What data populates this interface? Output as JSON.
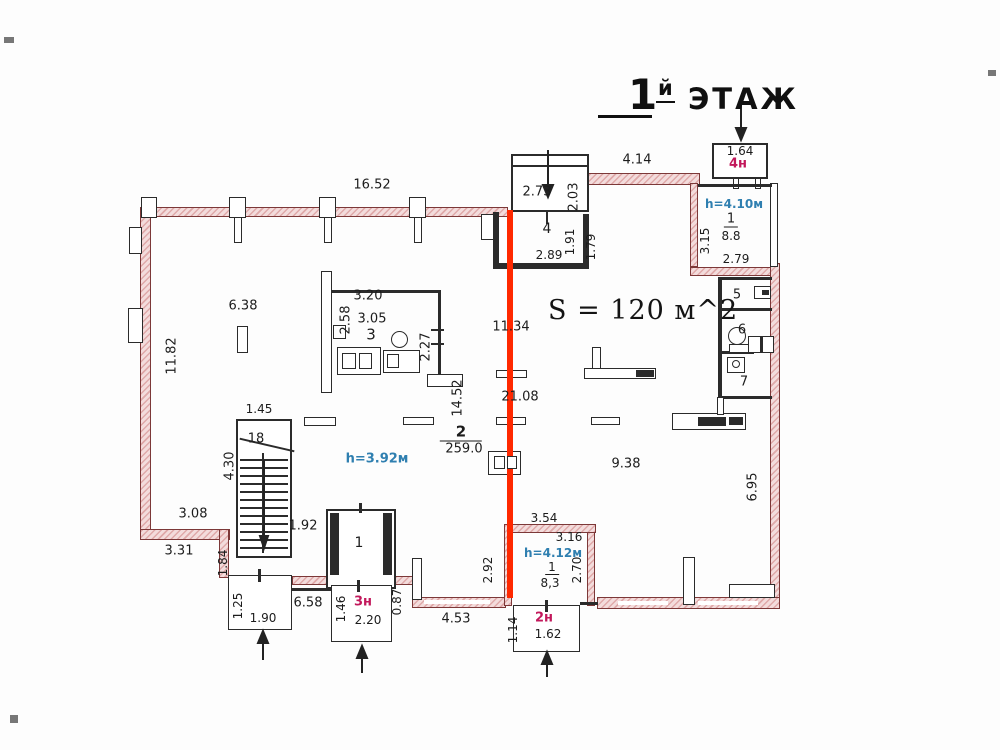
{
  "title": {
    "number": "1",
    "suffix": "й",
    "word": "ЭТАЖ"
  },
  "area_label": "S = 120 м^2",
  "colors": {
    "highlight": "#ff2800",
    "entrance_text": "#c2185b",
    "height_text": "#2f7fb0",
    "wall_accent": "#7c3838"
  },
  "labels": [
    {
      "name": "dim-16-52",
      "text": "16.52",
      "x": 372,
      "y": 185
    },
    {
      "name": "dim-4-14",
      "text": "4.14",
      "x": 637,
      "y": 160
    },
    {
      "name": "dim-2-73",
      "text": "2.73",
      "x": 537,
      "y": 192
    },
    {
      "name": "dim-2-03",
      "text": "2.03",
      "x": 574,
      "y": 197,
      "rot": 1
    },
    {
      "name": "dim-1-64",
      "text": "1.64",
      "x": 740,
      "y": 151,
      "size": 12
    },
    {
      "name": "entrance-4n",
      "text": "4н",
      "x": 738,
      "y": 164,
      "color": "#c2185b",
      "bold": 1
    },
    {
      "name": "height-room1",
      "text": "h=4.10м",
      "x": 734,
      "y": 204,
      "color": "#2f7fb0",
      "size": 12,
      "bold": 1
    },
    {
      "name": "room1-number",
      "text": "1",
      "x": 731,
      "y": 220,
      "size": 13,
      "ul": 1
    },
    {
      "name": "room1-area",
      "text": "8.8",
      "x": 731,
      "y": 236,
      "size": 12
    },
    {
      "name": "dim-3-15",
      "text": "3.15",
      "x": 705,
      "y": 241,
      "rot": 1,
      "size": 12
    },
    {
      "name": "dim-2-79",
      "text": "2.79",
      "x": 736,
      "y": 259,
      "size": 12
    },
    {
      "name": "room4-number",
      "text": "4",
      "x": 547,
      "y": 229,
      "size": 14
    },
    {
      "name": "dim-2-89",
      "text": "2.89",
      "x": 549,
      "y": 255,
      "size": 12
    },
    {
      "name": "dim-1-91",
      "text": "1.91",
      "x": 570,
      "y": 242,
      "rot": 1,
      "size": 12
    },
    {
      "name": "dim-1-79",
      "text": "1.79",
      "x": 591,
      "y": 247,
      "rot": 1,
      "size": 12
    },
    {
      "name": "dim-6-38",
      "text": "6.38",
      "x": 243,
      "y": 306
    },
    {
      "name": "dim-3-20",
      "text": "3.20",
      "x": 368,
      "y": 296
    },
    {
      "name": "dim-2-58",
      "text": "2.58",
      "x": 346,
      "y": 320,
      "rot": 1
    },
    {
      "name": "dim-3-05",
      "text": "3.05",
      "x": 372,
      "y": 319
    },
    {
      "name": "room3-number",
      "text": "3",
      "x": 371,
      "y": 335,
      "size": 15
    },
    {
      "name": "dim-2-27",
      "text": "2.27",
      "x": 426,
      "y": 347,
      "rot": 1
    },
    {
      "name": "dim-11-82",
      "text": "11.82",
      "x": 172,
      "y": 356,
      "rot": 1
    },
    {
      "name": "dim-11-34",
      "text": "11.34",
      "x": 511,
      "y": 327
    },
    {
      "name": "dim-21-08",
      "text": "21.08",
      "x": 520,
      "y": 397
    },
    {
      "name": "dim-14-52",
      "text": "14.52",
      "x": 458,
      "y": 398,
      "rot": 1
    },
    {
      "name": "room2-number",
      "text": "2",
      "x": 461,
      "y": 433,
      "size": 15,
      "bold": 1,
      "ulw": 1
    },
    {
      "name": "room2-area",
      "text": "259.0",
      "x": 464,
      "y": 449
    },
    {
      "name": "height-hall",
      "text": "h=3.92м",
      "x": 377,
      "y": 459,
      "color": "#2f7fb0",
      "bold": 1
    },
    {
      "name": "dim-1-45",
      "text": "1.45",
      "x": 259,
      "y": 409,
      "size": 12
    },
    {
      "name": "stair-count",
      "text": "18",
      "x": 256,
      "y": 439
    },
    {
      "name": "dim-4-30",
      "text": "4.30",
      "x": 230,
      "y": 466,
      "rot": 1
    },
    {
      "name": "dim-9-38",
      "text": "9.38",
      "x": 626,
      "y": 464
    },
    {
      "name": "dim-6-95",
      "text": "6.95",
      "x": 753,
      "y": 487,
      "rot": 1
    },
    {
      "name": "dim-3-08",
      "text": "3.08",
      "x": 193,
      "y": 514
    },
    {
      "name": "dim-3-31",
      "text": "3.31",
      "x": 179,
      "y": 551
    },
    {
      "name": "dim-1-84",
      "text": "1.84",
      "x": 223,
      "y": 563,
      "rot": 1,
      "size": 12
    },
    {
      "name": "dim-1-92",
      "text": "1.92",
      "x": 303,
      "y": 526
    },
    {
      "name": "elevator-number",
      "text": "1",
      "x": 359,
      "y": 543,
      "size": 14
    },
    {
      "name": "dim-3-54",
      "text": "3.54",
      "x": 544,
      "y": 518,
      "size": 12
    },
    {
      "name": "dim-3-16",
      "text": "3.16",
      "x": 569,
      "y": 537,
      "size": 12
    },
    {
      "name": "height-room83",
      "text": "h=4.12м",
      "x": 553,
      "y": 553,
      "color": "#2f7fb0",
      "size": 12,
      "bold": 1
    },
    {
      "name": "room83-number",
      "text": "1",
      "x": 552,
      "y": 568,
      "size": 12,
      "ul": 1
    },
    {
      "name": "room83-area",
      "text": "8,3",
      "x": 550,
      "y": 583,
      "size": 12
    },
    {
      "name": "dim-2-92",
      "text": "2.92",
      "x": 488,
      "y": 570,
      "rot": 1,
      "size": 12
    },
    {
      "name": "dim-2-70",
      "text": "2.70",
      "x": 577,
      "y": 570,
      "rot": 1,
      "size": 12
    },
    {
      "name": "dim-1-25",
      "text": "1.25",
      "x": 238,
      "y": 606,
      "rot": 1,
      "size": 12
    },
    {
      "name": "dim-1-90",
      "text": "1.90",
      "x": 263,
      "y": 618,
      "size": 12
    },
    {
      "name": "dim-6-58",
      "text": "6.58",
      "x": 308,
      "y": 603
    },
    {
      "name": "dim-1-46",
      "text": "1.46",
      "x": 341,
      "y": 609,
      "rot": 1,
      "size": 12
    },
    {
      "name": "entrance-3n",
      "text": "3н",
      "x": 363,
      "y": 602,
      "color": "#c2185b",
      "bold": 1
    },
    {
      "name": "dim-2-20",
      "text": "2.20",
      "x": 368,
      "y": 620,
      "size": 12
    },
    {
      "name": "dim-0-87",
      "text": "0.87",
      "x": 397,
      "y": 602,
      "rot": 1,
      "size": 12
    },
    {
      "name": "dim-4-53",
      "text": "4.53",
      "x": 456,
      "y": 619
    },
    {
      "name": "dim-1-14",
      "text": "1.14",
      "x": 513,
      "y": 630,
      "rot": 1,
      "size": 12
    },
    {
      "name": "entrance-2n",
      "text": "2н",
      "x": 544,
      "y": 618,
      "color": "#c2185b",
      "bold": 1
    },
    {
      "name": "dim-1-62",
      "text": "1.62",
      "x": 548,
      "y": 634,
      "size": 12
    },
    {
      "name": "room5-number",
      "text": "5",
      "x": 737,
      "y": 295,
      "size": 13
    },
    {
      "name": "room6-number",
      "text": "6",
      "x": 742,
      "y": 330,
      "size": 13
    },
    {
      "name": "room7-number",
      "text": "7",
      "x": 744,
      "y": 382,
      "size": 13
    }
  ]
}
